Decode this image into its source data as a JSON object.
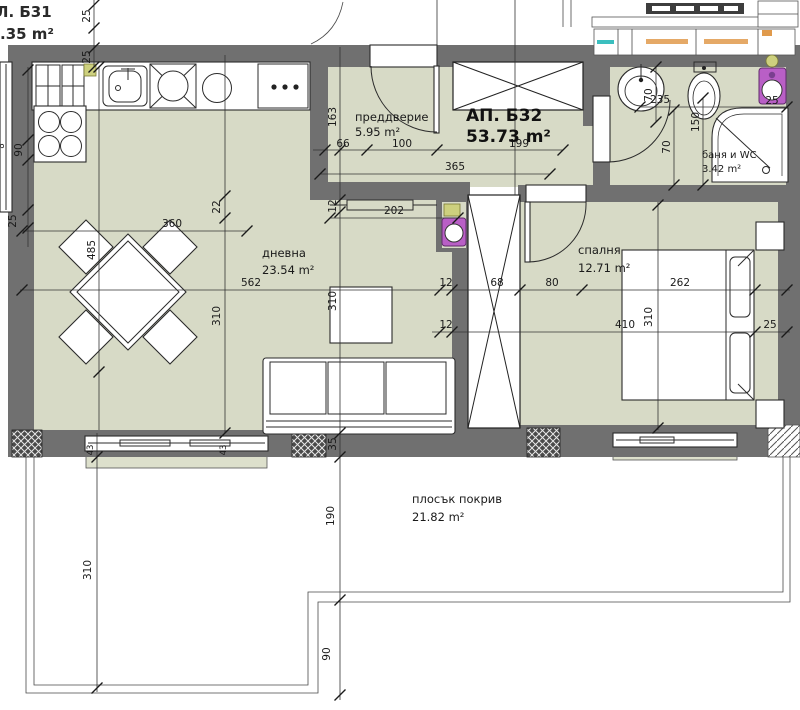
{
  "apartment": {
    "name": "АП. Б32",
    "area": "53.73 m²"
  },
  "neighbor": {
    "name": "Л. Б31",
    "area": ".35 m²"
  },
  "rooms": {
    "hall": {
      "name": "преддверие",
      "area": "5.95 m²"
    },
    "living": {
      "name": "дневна",
      "area": "23.54 m²"
    },
    "bedroom": {
      "name": "спалня",
      "area": "12.71 m²"
    },
    "bath": {
      "name": "баня и WC",
      "area": "3.42 m²"
    },
    "roof": {
      "name": "плосък покрив",
      "area": "21.82 m²"
    }
  },
  "dims": {
    "t66": "66",
    "t100": "100",
    "t199": "199",
    "t365": "365",
    "t202": "202",
    "t562": "562",
    "t12a": "12",
    "t68": "68",
    "t80": "80",
    "t262": "262",
    "t12b": "12",
    "t410": "410",
    "t25_right": "25",
    "t235": "235",
    "t25_bath": "25",
    "t360": "360",
    "t25_top1": "25",
    "t25_top2": "25",
    "t90_left": "90",
    "t25_left": "25",
    "t8_left": "8",
    "t163": "163",
    "t12c": "12",
    "t22": "22",
    "t310_live": "310",
    "t310_mid": "310",
    "t485": "485",
    "t310_bed": "310",
    "t150": "150",
    "t70a": "70",
    "t70b": "70",
    "t35": "35",
    "t43a": "43",
    "t43b": "43",
    "t190": "190",
    "t310_roof": "310",
    "t90_roof": "90"
  },
  "colors": {
    "floor": "#d7dac6",
    "wall": "#707070",
    "accent_purple": "#b95fc6",
    "accent_yellow": "#cdd07e",
    "accent_teal": "#3bbfbf",
    "accent_orange": "#e09a4c"
  },
  "icons": {
    "shaft": "x-crossed-shaft",
    "closet": "x-crossed-closet",
    "plumbing": "purple-riser-valve"
  }
}
